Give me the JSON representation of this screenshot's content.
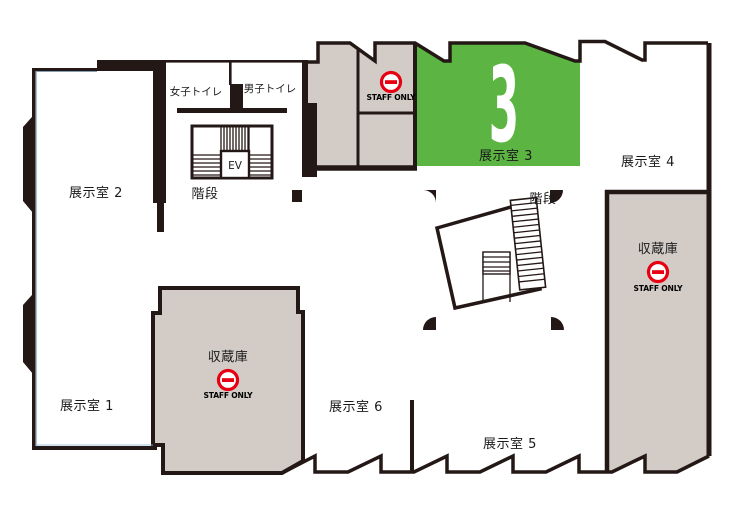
{
  "title": "museum-floor-map",
  "colors": {
    "wall": "#231815",
    "gray": "#d2cbc6",
    "green": "#5cb542",
    "red": "#e60012",
    "blue": "#8fb8d8"
  },
  "rooms": {
    "room1": {
      "label": "展示室 1"
    },
    "room2": {
      "label": "展示室 2"
    },
    "room3": {
      "label": "展示室 3",
      "number": "3"
    },
    "room4": {
      "label": "展示室 4"
    },
    "room5": {
      "label": "展示室 5"
    },
    "room6": {
      "label": "展示室 6"
    }
  },
  "facilities": {
    "womens_toilet": {
      "label": "女子トイレ"
    },
    "mens_toilet": {
      "label": "男子トイレ"
    },
    "elevator": {
      "label": "EV"
    },
    "stairs_main": {
      "label": "階段"
    },
    "stairs_center": {
      "label": "階段"
    },
    "staff_room": {
      "staff_only": "STAFF ONLY"
    },
    "storage_center": {
      "label": "収蔵庫",
      "staff_only": "STAFF ONLY"
    },
    "storage_east": {
      "label": "収蔵庫",
      "staff_only": "STAFF ONLY"
    }
  }
}
